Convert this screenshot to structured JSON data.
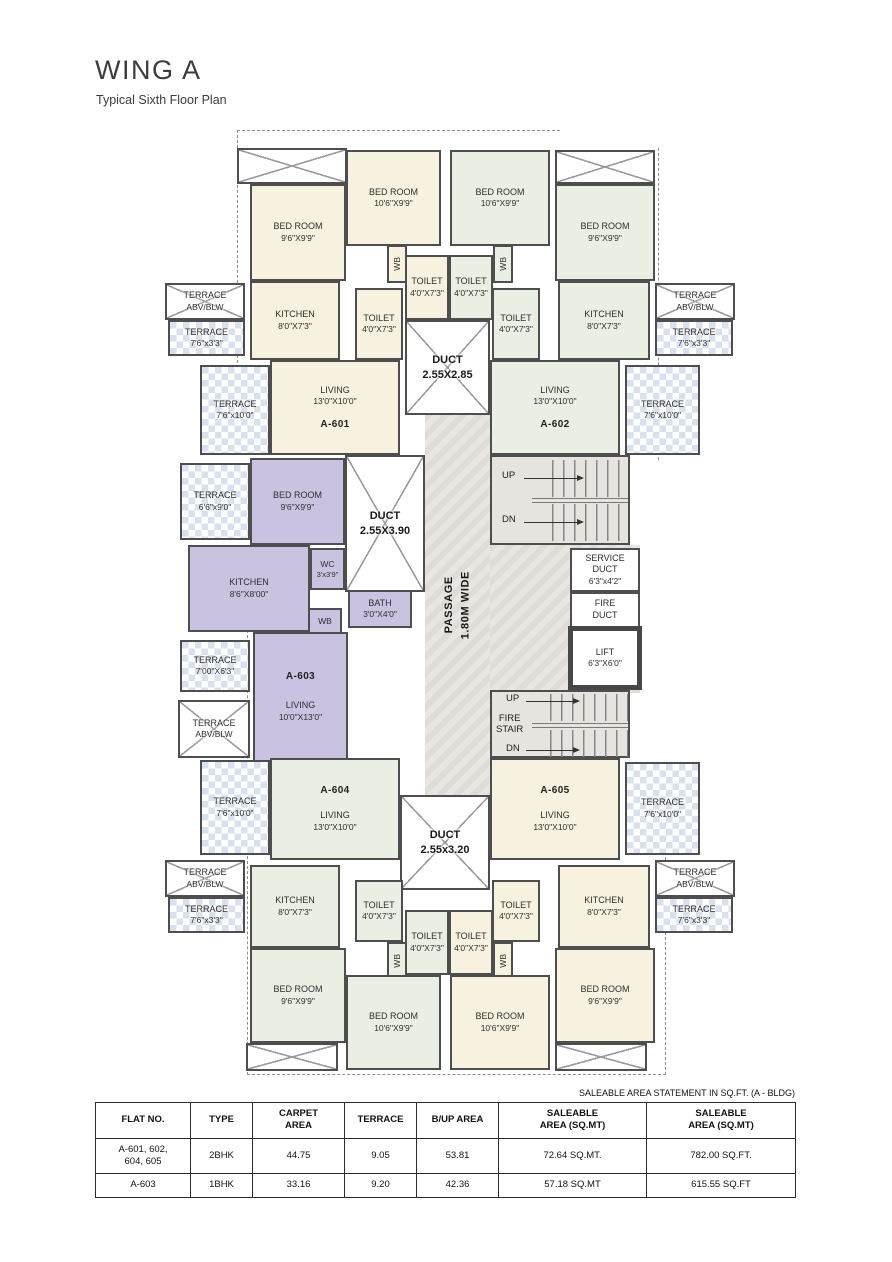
{
  "title": "WING A",
  "subtitle": "Typical Sixth Floor Plan",
  "plan": {
    "units": {
      "a601": "A-601",
      "a602": "A-602",
      "a603": "A-603",
      "a604": "A-604",
      "a605": "A-605"
    },
    "labels": {
      "bedroomS": {
        "name": "BED ROOM",
        "dims": "9'6\"X9'9\""
      },
      "bedroomL": {
        "name": "BED ROOM",
        "dims": "10'6\"X9'9\""
      },
      "kitchen": {
        "name": "KITCHEN",
        "dims": "8'0\"X7'3\""
      },
      "kitchen603": {
        "name": "KITCHEN",
        "dims": "8'6\"X8'00\""
      },
      "toilet": {
        "name": "TOILET",
        "dims": "4'0\"X7'3\""
      },
      "living": {
        "name": "LIVING",
        "dims": "13'0\"X10'0\""
      },
      "living603": {
        "name": "LIVING",
        "dims": "10'0\"X13'0\""
      },
      "wc": {
        "name": "WC",
        "dims": "3'x3'9\""
      },
      "bath": {
        "name": "BATH",
        "dims": "3'0\"X4'0\""
      },
      "wb": "WB",
      "terraceAbv": {
        "name": "TERRACE",
        "dims": "ABV/BLW"
      },
      "terrace33": {
        "name": "TERRACE",
        "dims": "7'6\"x3'3\""
      },
      "terrace100": {
        "name": "TERRACE",
        "dims": "7'6\"x10'0\""
      },
      "terrace690": {
        "name": "TERRACE",
        "dims": "6'6\"x9'0\""
      },
      "terrace763": {
        "name": "TERRACE",
        "dims": "7'00\"X6'3\""
      },
      "ductTop": {
        "name": "DUCT",
        "dims": "2.55X2.85"
      },
      "ductMid": {
        "name": "DUCT",
        "dims": "2.55X3.90"
      },
      "ductBot": {
        "name": "DUCT",
        "dims": "2.55x3.20"
      },
      "serviceDuct": {
        "name": "SERVICE\nDUCT",
        "dims": "6'3\"x4'2\""
      },
      "fireDuct": {
        "name": "FIRE\nDUCT"
      },
      "lift": {
        "name": "LIFT",
        "dims": "6'3\"X6'0\""
      },
      "passage": {
        "text": "PASSAGE\n1.80M WIDE"
      },
      "stairs": {
        "up": "UP",
        "dn": "DN",
        "fire": "FIRE\nSTAIR"
      }
    }
  },
  "colors": {
    "unit_2bhk_cream": "#f7f2e0",
    "unit_2bhk_green": "#eaefe4",
    "unit_1bhk_purple": "#c9c3e1",
    "terrace_checker": "#d9e1ef",
    "wall": "#4e4e4e"
  },
  "table": {
    "note": "SALEABLE AREA STATEMENT IN SQ.FT. (A - BLDG)",
    "headers": [
      "FLAT NO.",
      "TYPE",
      "CARPET\nAREA",
      "TERRACE",
      "B/UP AREA",
      "SALEABLE\nAREA (SQ.MT)",
      "SALEABLE\nAREA (SQ.MT)"
    ],
    "rows": [
      [
        "A-601, 602,\n604, 605",
        "2BHK",
        "44.75",
        "9.05",
        "53.81",
        "72.64 SQ.MT.",
        "782.00 SQ.FT."
      ],
      [
        "A-603",
        "1BHK",
        "33.16",
        "9.20",
        "42.36",
        "57.18 SQ.MT",
        "615.55 SQ.FT"
      ]
    ]
  }
}
